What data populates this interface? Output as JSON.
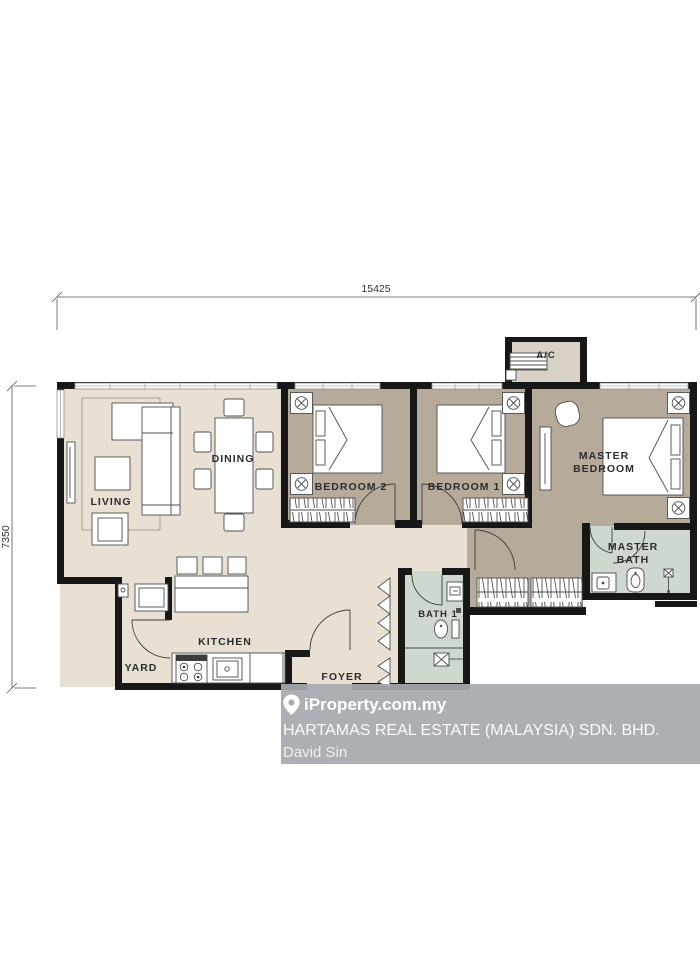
{
  "dimensions": {
    "width_label": "15425",
    "height_label": "7350"
  },
  "rooms": {
    "living": "LIVING",
    "dining": "DINING",
    "kitchen": "KITCHEN",
    "yard": "YARD",
    "foyer": "FOYER",
    "bath1": "BATH 1",
    "bedroom2": "BEDROOM 2",
    "bedroom1": "BEDROOM 1",
    "master_bedroom_line1": "MASTER",
    "master_bedroom_line2": "BEDROOM",
    "master_bath_line1": "MASTER",
    "master_bath_line2": "BATH",
    "ac": "A/C"
  },
  "watermark": {
    "brand": "iProperty.com.my",
    "agency": "HARTAMAS REAL ESTATE (MALAYSIA) SDN. BHD.",
    "agent": "David Sin"
  },
  "colors": {
    "floor_light": "#e8e1d3",
    "floor_dark": "#b6aa9b",
    "floor_bath": "#ced8cf",
    "floor_ac": "#d8d1c5",
    "wall": "#171717",
    "watermark_bg": "#a6aaae"
  }
}
